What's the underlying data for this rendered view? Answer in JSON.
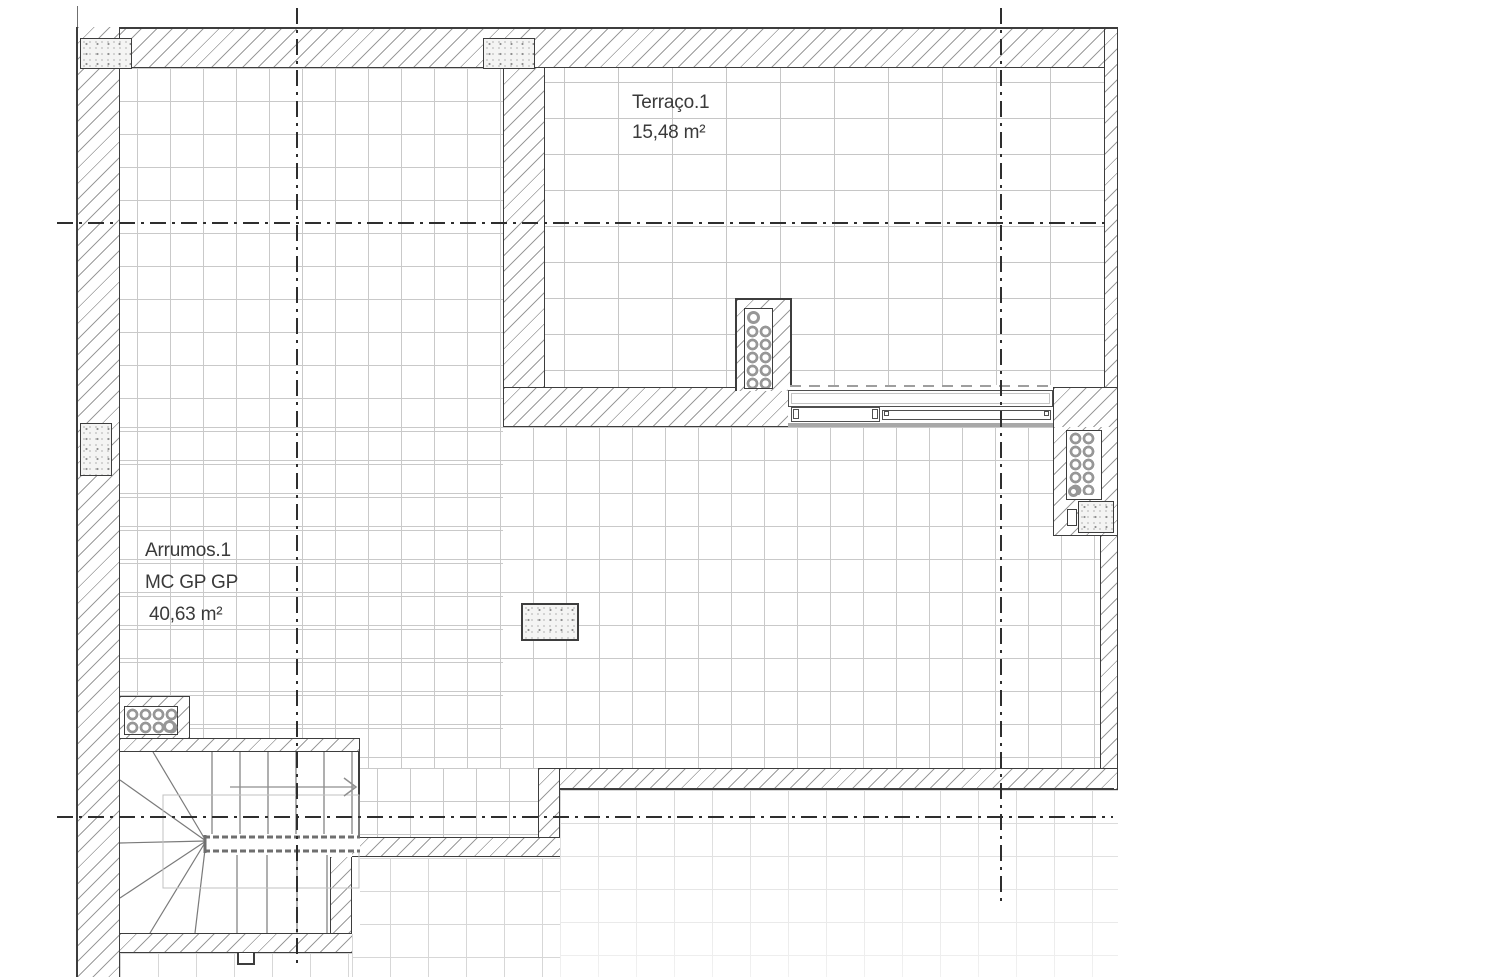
{
  "title": "Floor plan - storage and terrace level",
  "rooms": {
    "terraco": {
      "name": "Terraço.1",
      "area": "15,48 m²"
    },
    "arrumos": {
      "name": "Arrumos.1",
      "code": "MC GP GP",
      "area": "40,63 m²"
    }
  },
  "colors": {
    "wall_line": "#3d3d3d",
    "hatch_line": "#9b9b9b",
    "tile_line": "#c9c9c9",
    "tile_line_faded": "#d7d7d7",
    "centerline": "#2e2e2e",
    "label_text": "#3a3a3a",
    "stipple_dot": "#8f8f8f",
    "pipe_ring": "#979797"
  }
}
